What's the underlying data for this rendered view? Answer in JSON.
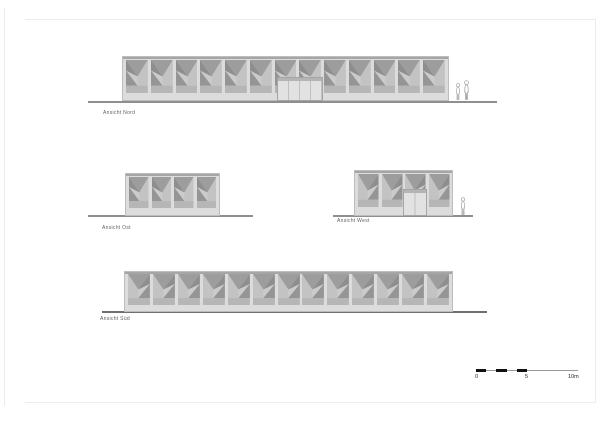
{
  "sheet": {
    "type": "architectural elevation drawing"
  },
  "elevations": [
    {
      "key": "nord",
      "label": "Ansicht Nord",
      "bays": 13,
      "has_door": true,
      "figures": 2
    },
    {
      "key": "ost",
      "label": "Ansicht Ost",
      "bays": 4,
      "has_door": false,
      "figures": 0
    },
    {
      "key": "west",
      "label": "Ansicht West",
      "bays": 4,
      "has_door": true,
      "figures": 1
    },
    {
      "key": "sued",
      "label": "Ansicht Süd",
      "bays": 13,
      "has_door": false,
      "figures": 0
    }
  ],
  "scale_bar": {
    "tick_labels": [
      "0",
      "5",
      "10m"
    ],
    "black_segments_m": [
      [
        0,
        1
      ],
      [
        2,
        3
      ],
      [
        4,
        5
      ]
    ],
    "px_per_m": 10.2
  },
  "colors": {
    "sheet_bg": "#ffffff",
    "frame": "#ececec",
    "facade": "#dcdcdc",
    "facade_border": "#bdbdbd",
    "roof_edge": "#a6a6a6",
    "bay_bg": "#cbcbcb",
    "fold_dark": "#8e8e8e",
    "fold_mid": "#9d9d9d",
    "fold_light": "#c3c3c3",
    "fold_lower": "#959595",
    "fold_sill": "#b6b6b6",
    "door_fill": "#e2e2e2",
    "door_frame": "#a5a5a5",
    "door_seam": "#c0c0c0",
    "door_header": "#b4b4b4",
    "ground": "#8f8f8f",
    "ground_dark": "#6f6f6f",
    "figure": "#9a9a9a",
    "label_text": "#5f5f5f",
    "scale_line": "#9a9a9a",
    "scale_black": "#111111",
    "scale_text": "#1c1c1c"
  }
}
